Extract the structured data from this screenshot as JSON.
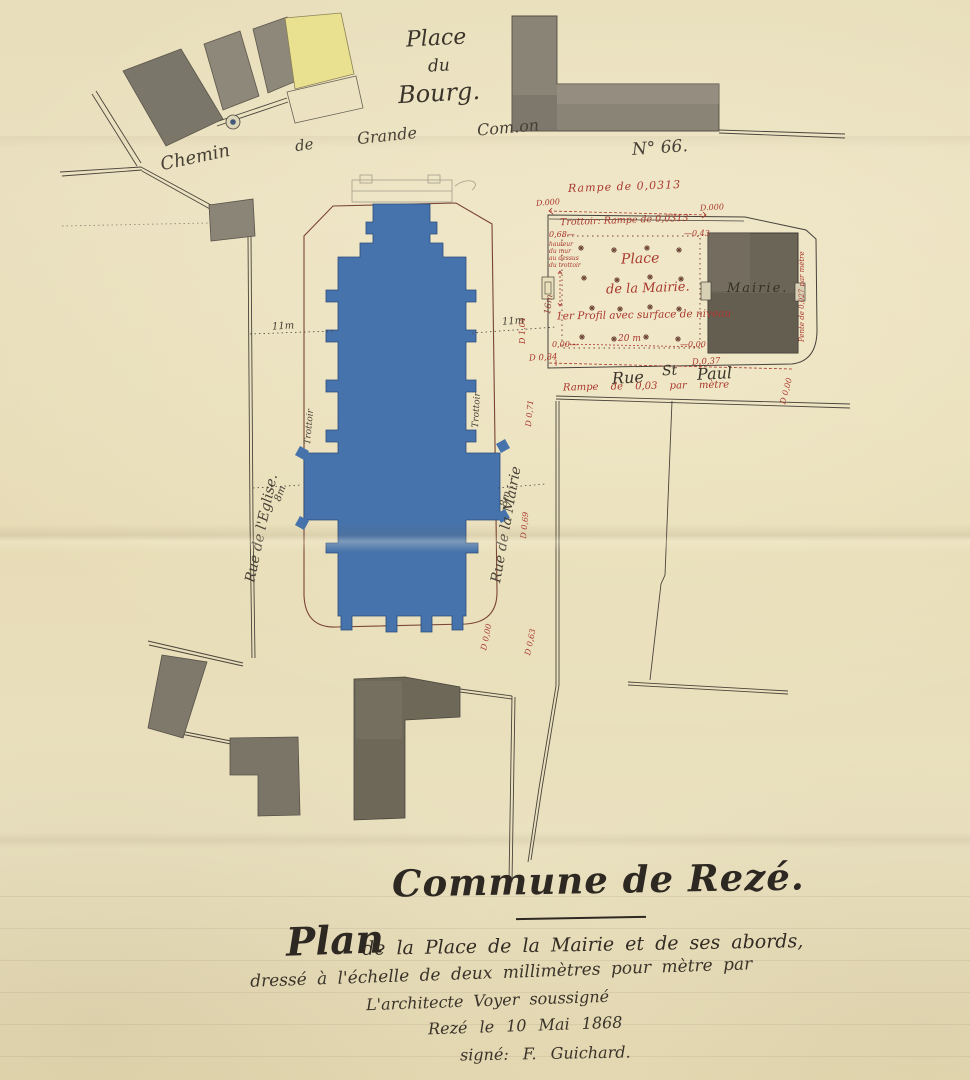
{
  "map": {
    "place_du_bourg": {
      "line1": "Place",
      "line2": "du",
      "line3": "Bourg."
    },
    "chemin": {
      "w1": "Chemin",
      "w2": "de",
      "w3": "Grande",
      "w4": "Com.on",
      "w5": "N° 66."
    },
    "streets": {
      "rue_eglise": "Rue de l'Eglise.",
      "rue_mairie": "Rue de la Mairie",
      "trottoir_left": "Trottoir",
      "trottoir_right": "Trottoir",
      "rue_st_paul_w1": "Rue",
      "rue_st_paul_w2": "St",
      "rue_st_paul_w3": "Paul"
    },
    "place_mairie": {
      "line1": "Place",
      "line2": "de la Mairie.",
      "mairie": "Mairie.",
      "profil": "1er Profil avec surface de niveau"
    },
    "red_notes": {
      "rampe_top": "Rampe de 0,0313",
      "trottoir_rampe": "Trottoir: Rampe de 0,0313",
      "d000_left": "D.000",
      "d000_right": "D.000",
      "h068": "0,68—",
      "wall1": "hauteur",
      "wall2": "du mur",
      "wall3": "au dessus",
      "wall4": "du trottoir",
      "minus043": "—0,43",
      "zero_left": "0,00—",
      "dim20": "20 m",
      "zero_right": "—0,00",
      "d084": "D 0,84",
      "d037": "D 0,37",
      "d104": "D 1,04",
      "d071": "D 0,71",
      "d069": "D 0,69",
      "d000b": "D 0,00",
      "d063": "D 0,63",
      "d000r": "D 0,00",
      "pente": "Pente de 0,027 par mètre",
      "rampe_stpaul": "Rampe de 0,03 par mètre"
    },
    "dims": {
      "eleven_left": "11m",
      "eleven_right": "11m",
      "eight_left": "8m",
      "eight_right": "8m",
      "sixteen": "16m"
    }
  },
  "title_block": {
    "commune": "Commune de Rezé.",
    "plan_word": "Plan",
    "plan_rest": "de la Place de la Mairie et de ses abords,",
    "line2": "dressé à l'échelle de deux millimètres pour mètre par",
    "line3": "L'architecte Voyer soussigné",
    "line4": "Rezé le 10 Mai 1868",
    "line5": "signé: F. Guichard."
  },
  "colors": {
    "paper": "#e9dfbb",
    "ink": "#3b342b",
    "red_ink": "#a9382e",
    "plaza_outline": "#7a4434",
    "church_blue": "#4673ab",
    "building_gray": "#8a8477",
    "building_dark": "#6e6859",
    "building_yellow": "#e9e190"
  }
}
